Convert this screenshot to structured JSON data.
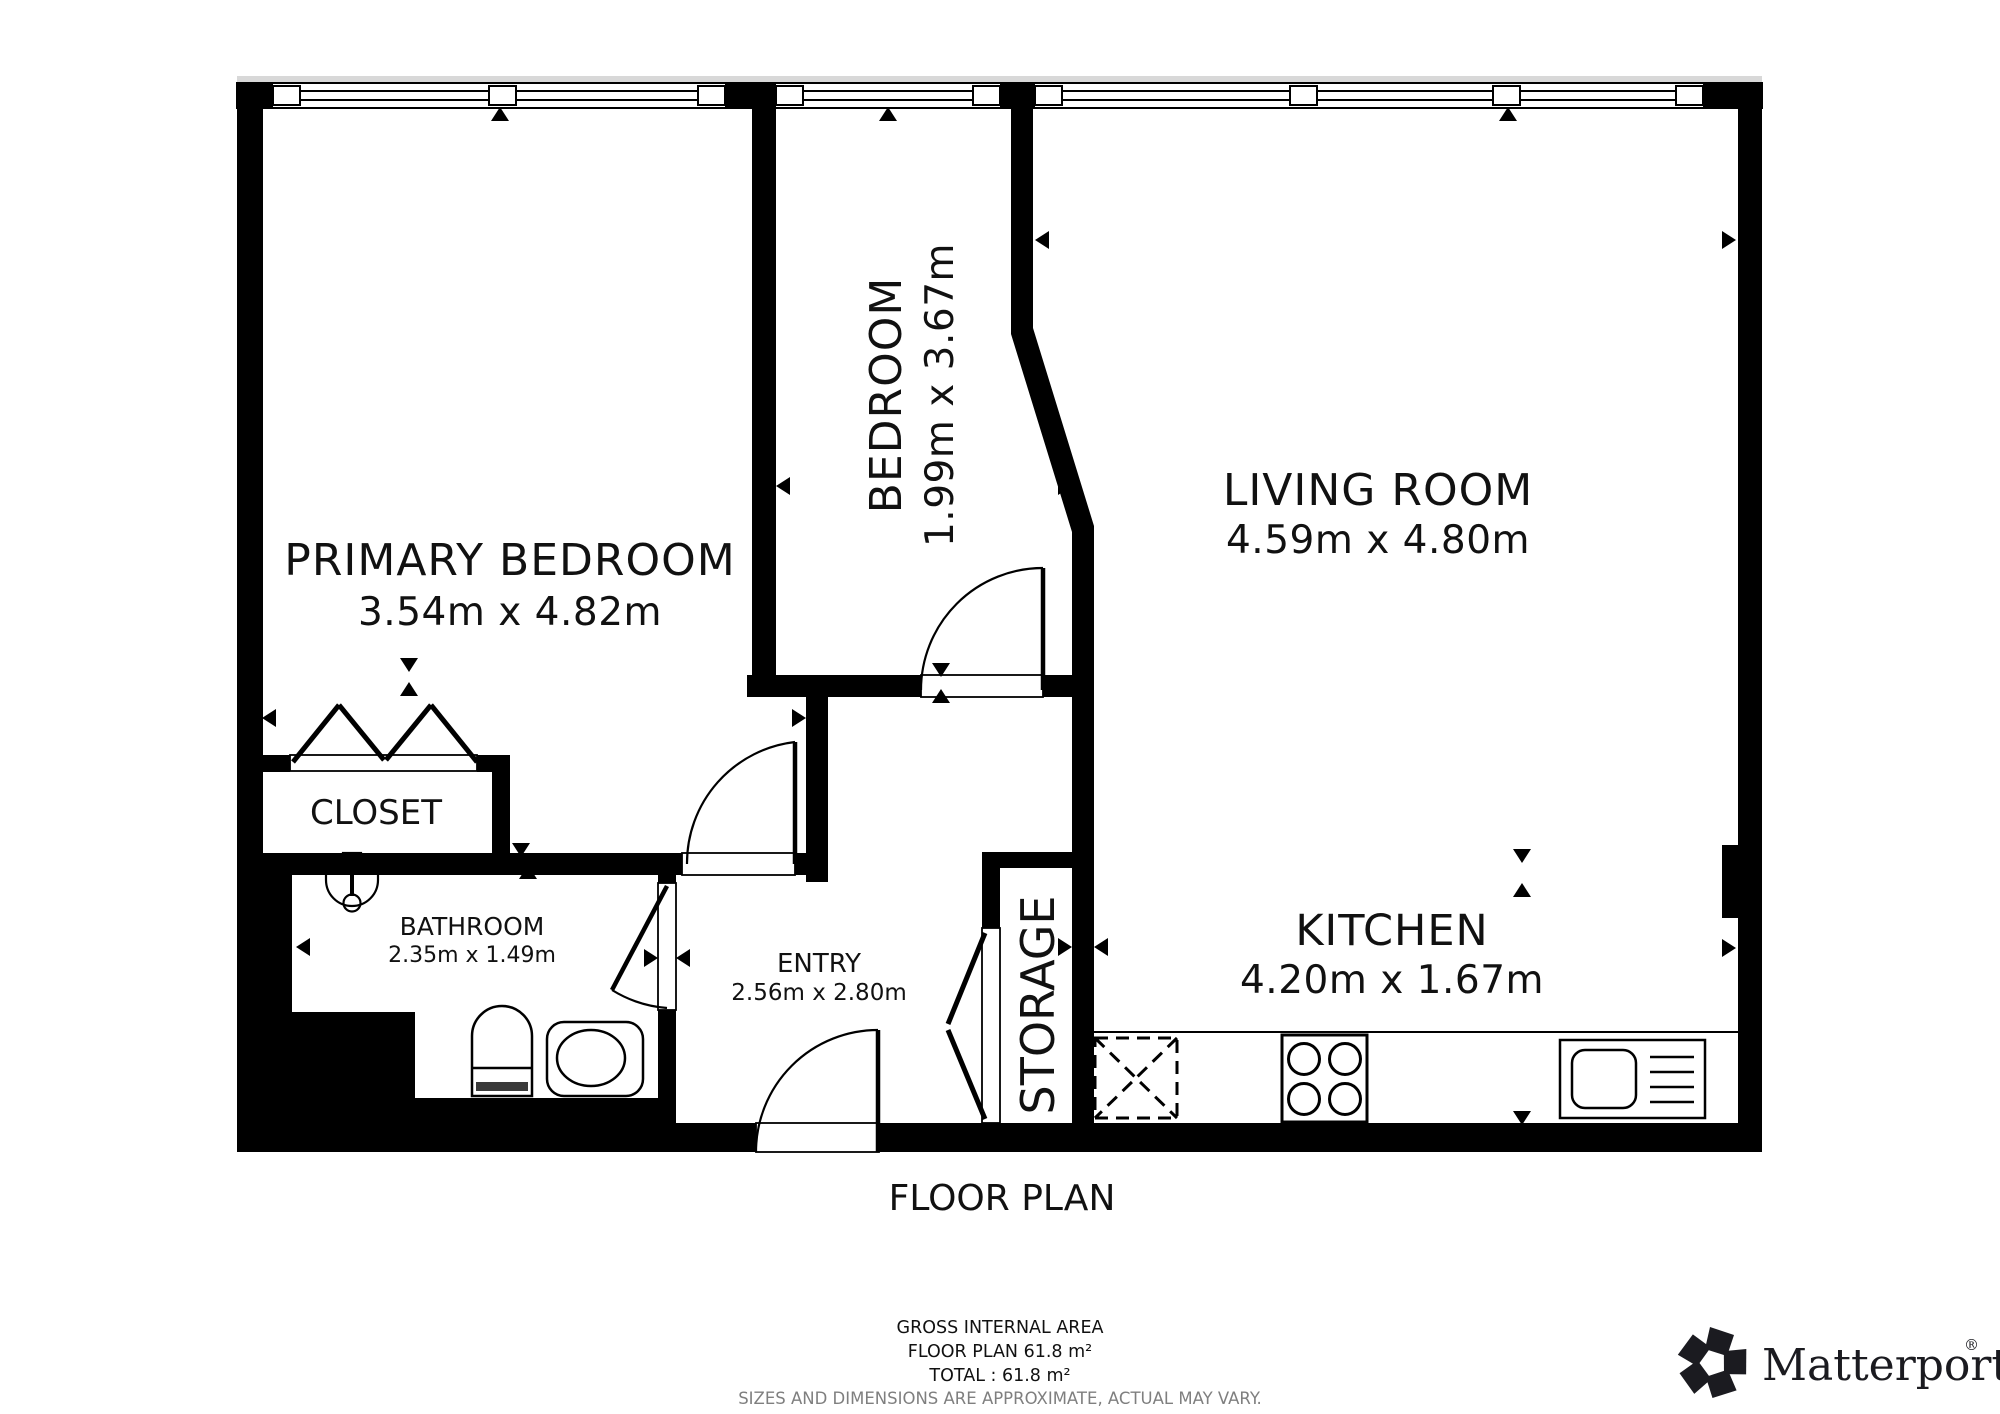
{
  "plan": {
    "title": "FLOOR PLAN",
    "rooms": {
      "primary_bedroom": {
        "name": "PRIMARY BEDROOM",
        "dims": "3.54m x 4.82m"
      },
      "bedroom": {
        "name": "BEDROOM",
        "dims": "1.99m x 3.67m"
      },
      "living_room": {
        "name": "LIVING ROOM",
        "dims": "4.59m x 4.80m"
      },
      "kitchen": {
        "name": "KITCHEN",
        "dims": "4.20m x 1.67m"
      },
      "entry": {
        "name": "ENTRY",
        "dims": "2.56m x 2.80m"
      },
      "bathroom": {
        "name": "BATHROOM",
        "dims": "2.35m x 1.49m"
      },
      "closet": {
        "name": "CLOSET"
      },
      "storage": {
        "name": "STORAGE"
      }
    }
  },
  "footer": {
    "gross_internal_area": "GROSS INTERNAL AREA",
    "floor_plan_area": "FLOOR PLAN 61.8 m²",
    "total_area": "TOTAL :  61.8 m²",
    "disclaimer": "SIZES AND DIMENSIONS ARE APPROXIMATE, ACTUAL MAY VARY."
  },
  "logo": {
    "brand": "Matterport",
    "registered": "®"
  },
  "colors": {
    "wall": "#000000",
    "background": "#ffffff",
    "disclaimer": "#7f7f7f"
  }
}
